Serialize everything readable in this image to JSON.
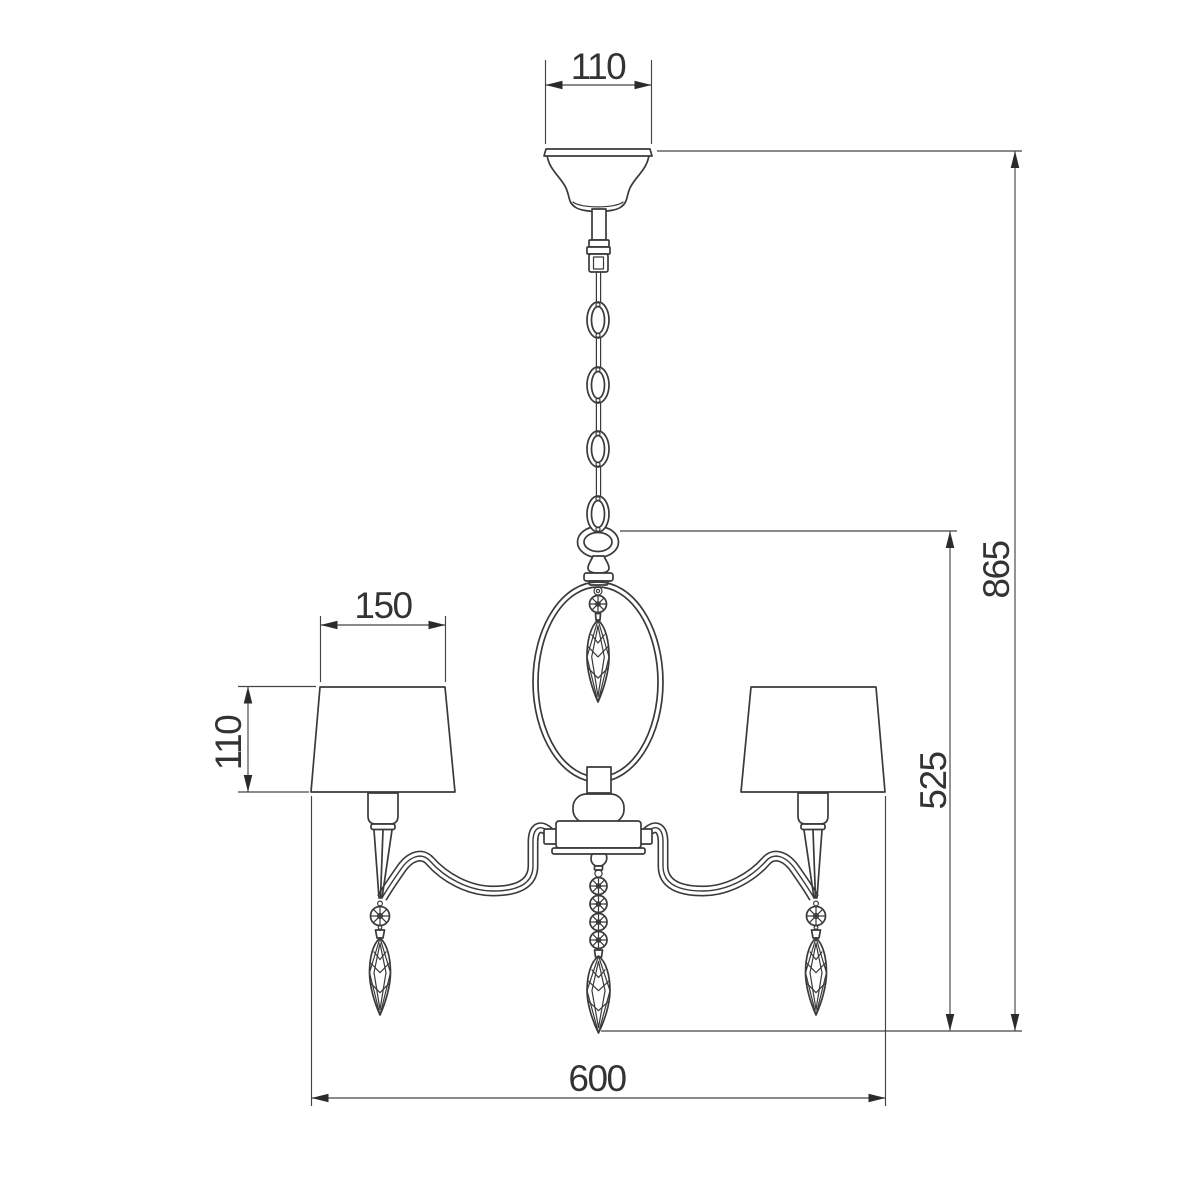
{
  "drawing": {
    "background_color": "#ffffff",
    "line_color": "#3a3a3a",
    "dimension_text_color": "#333333",
    "dimensions": {
      "canopy_width": "110",
      "shade_width": "150",
      "shade_height": "110",
      "overall_height": "865",
      "body_height": "525",
      "overall_width": "600"
    }
  }
}
